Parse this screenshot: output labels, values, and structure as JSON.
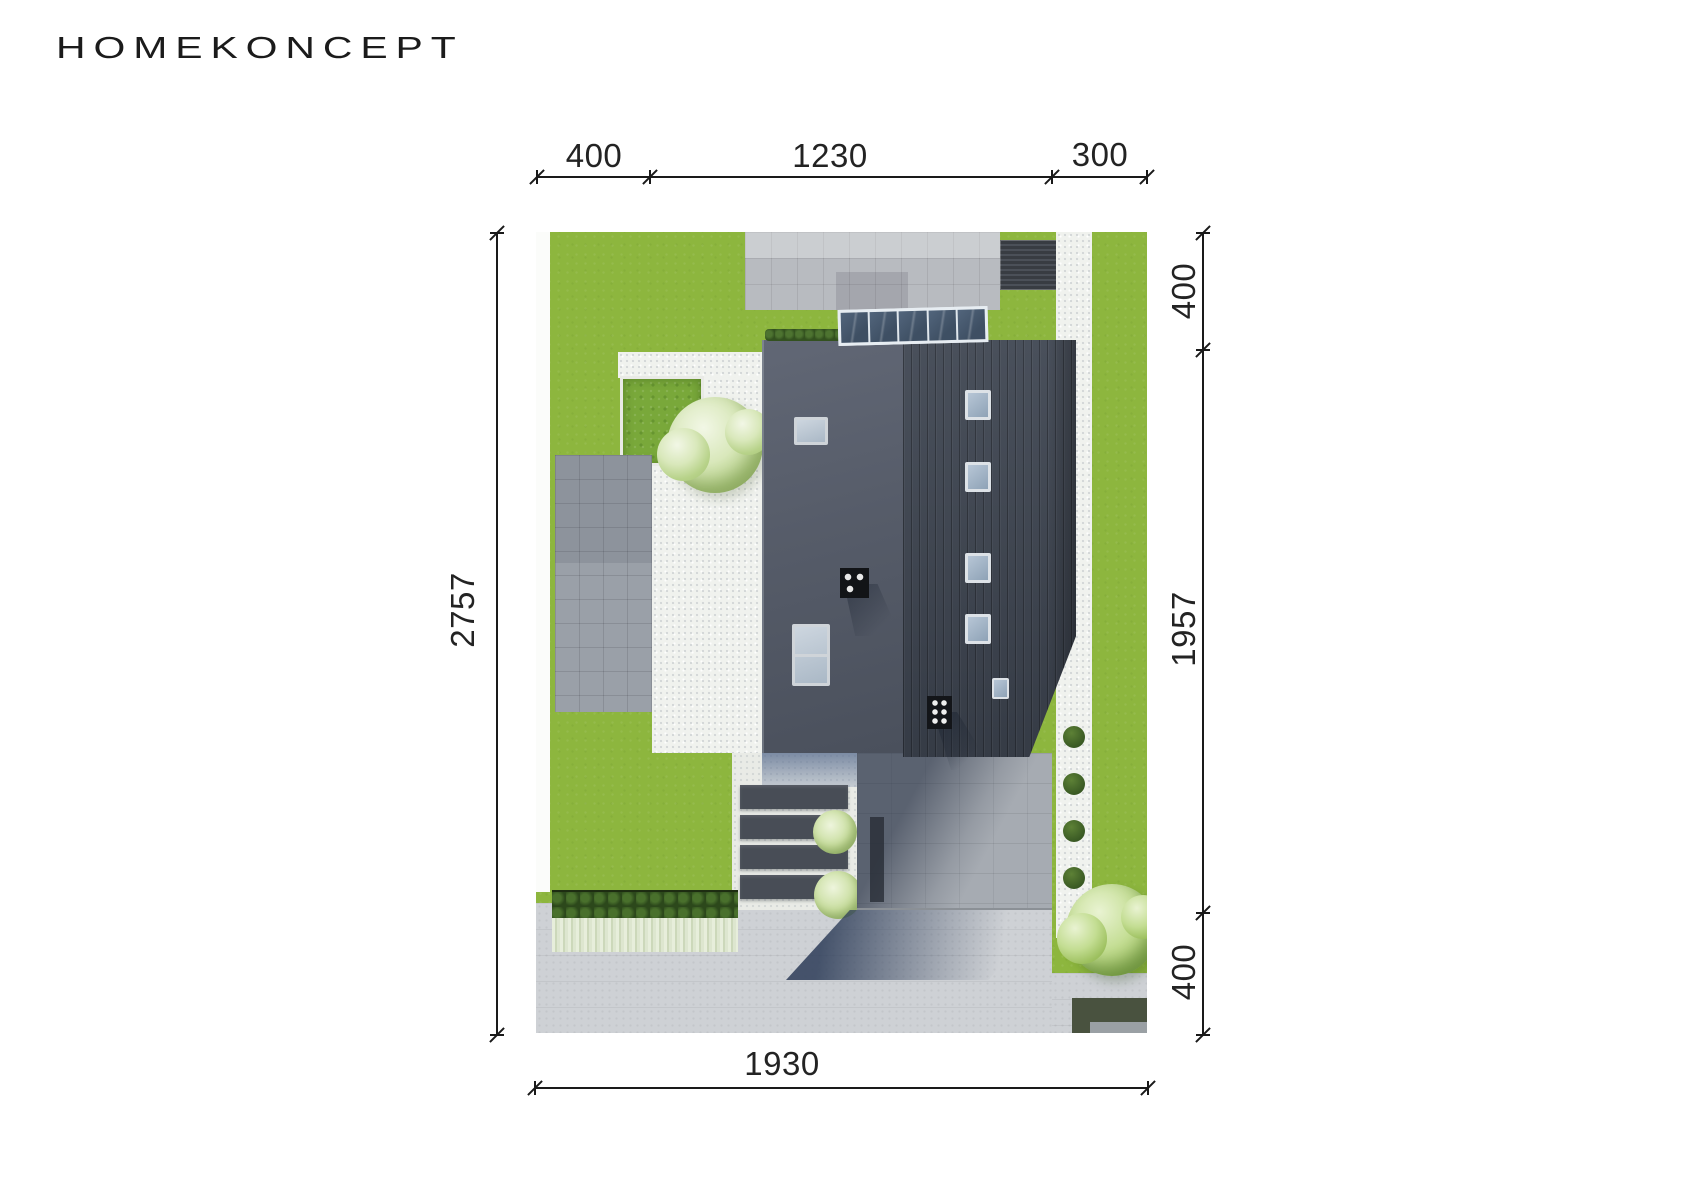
{
  "logo": {
    "text": "HOMEKONCEPT"
  },
  "site_plan": {
    "dimensions": {
      "top": [
        "400",
        "1230",
        "300"
      ],
      "right_top_to_bottom": [
        "400",
        "1957",
        "400"
      ],
      "left": [
        "2757"
      ],
      "bottom": [
        "1930"
      ]
    },
    "colors": {
      "lawn": "#8db63e",
      "roof_west": "#545a67",
      "roof_east_seam": "#3e4551",
      "paving": "#b8bbc0",
      "gravel": "#f0f2ee",
      "road": "#ced1d5",
      "canopy_glass": "#47586d",
      "dimension_line": "#1a1a1a"
    }
  }
}
